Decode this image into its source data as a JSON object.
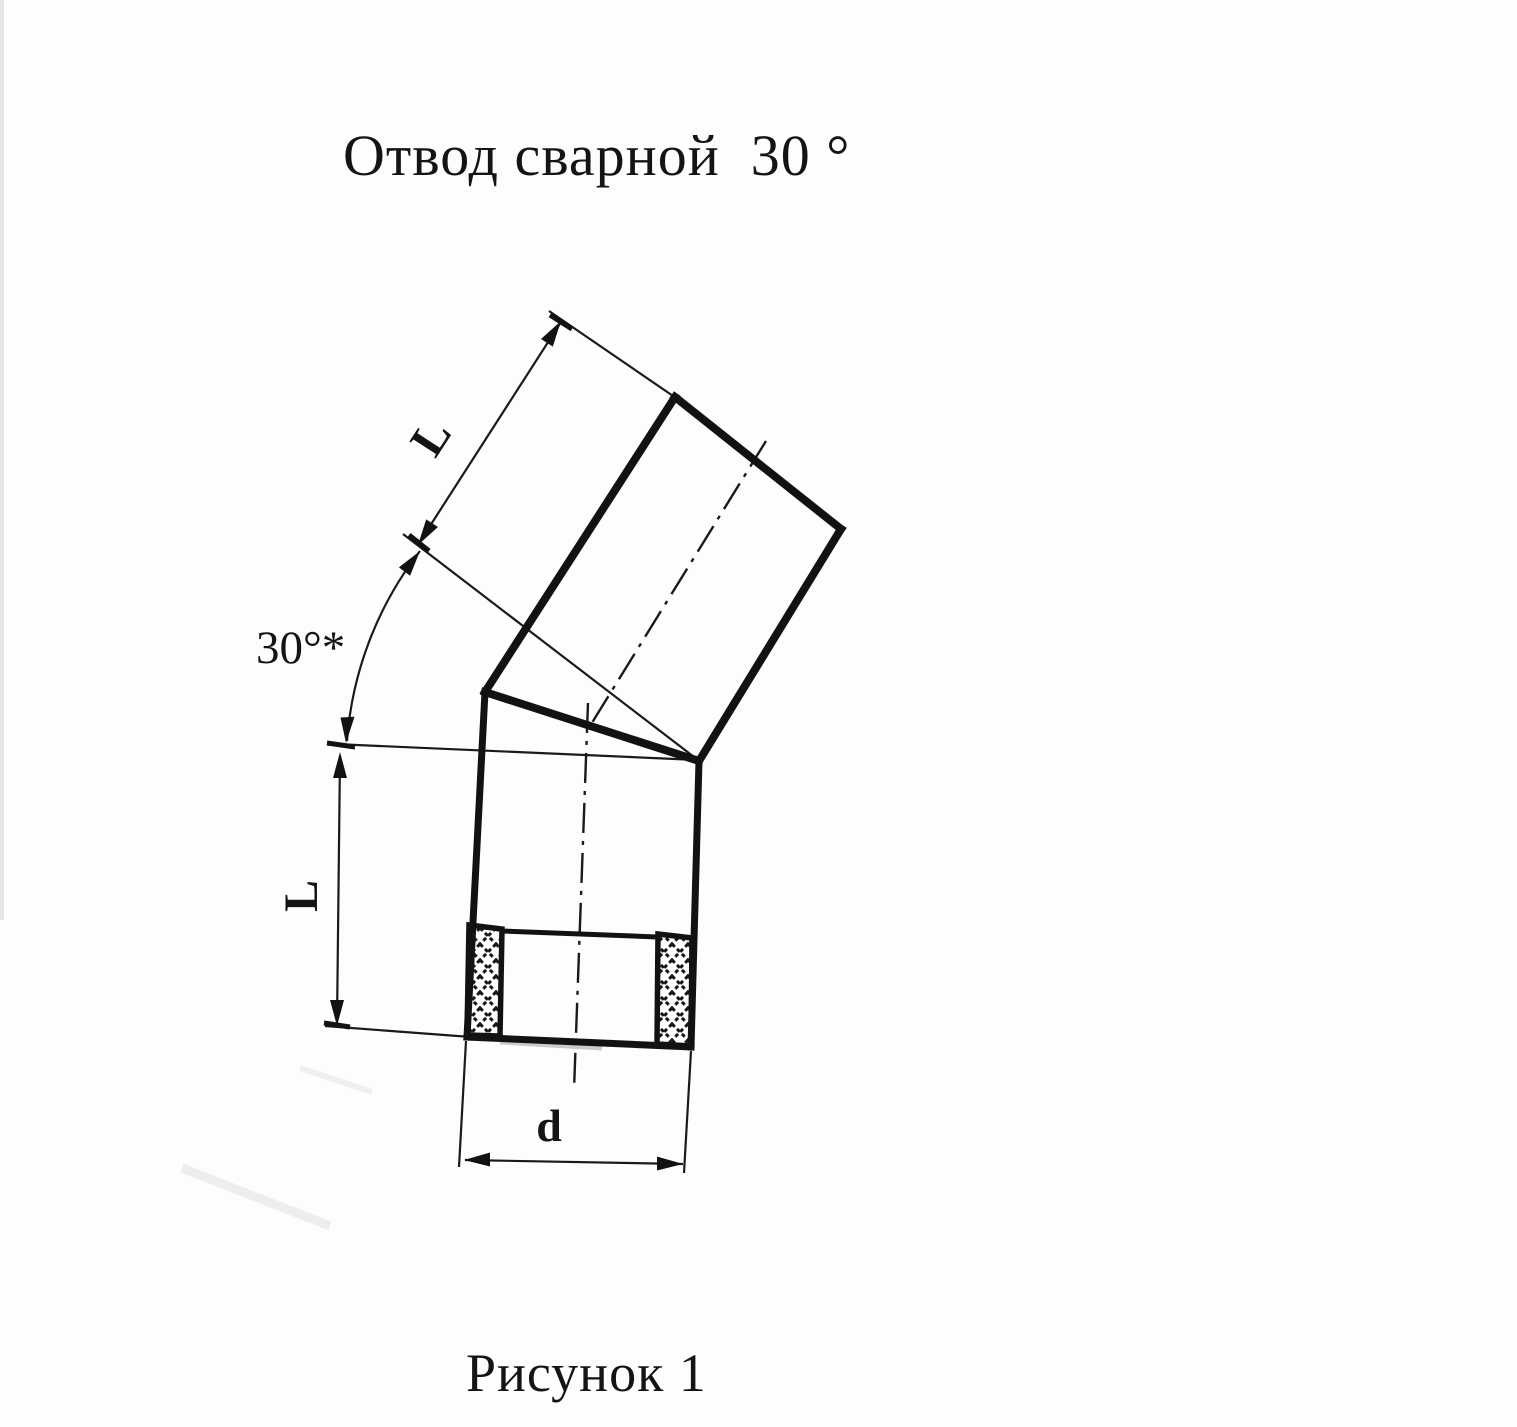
{
  "page": {
    "title": "Отвод сварной  30 °",
    "caption": "Рисунок 1"
  },
  "drawing": {
    "angle_label": "30°*",
    "upper_length_label": "L",
    "lower_length_label": "L",
    "diameter_label": "d",
    "ink_color": "#141414",
    "paper_color": "#fdfdfc"
  }
}
